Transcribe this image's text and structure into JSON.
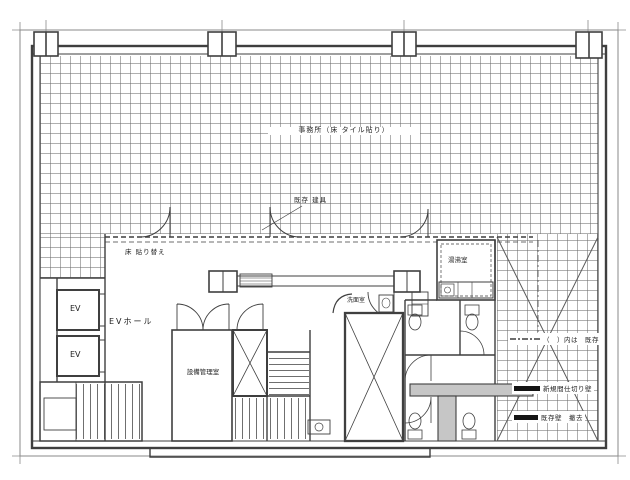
{
  "drawing": {
    "type": "architectural-floor-plan",
    "labels": {
      "office": "事務所（床 タイル貼り）",
      "fixture_note": "既存 建具",
      "floor_note": "床 貼り替え",
      "ev_hall": "EVホール",
      "ev_1": "EV",
      "ev_2": "EV",
      "equipment_room": "設備管理室",
      "water_room": "湯沸室",
      "washroom": "洗面室"
    },
    "legend": {
      "items": [
        {
          "swatch": "dash-dot-line",
          "label": "（　）内は　既存"
        },
        {
          "swatch": "solid-black-bar",
          "label": "新規間仕切り壁"
        },
        {
          "swatch": "solid-black-bar",
          "label": "既存壁　撤去"
        }
      ]
    },
    "colors": {
      "paper": "#ffffff",
      "line": "#3f3f3f",
      "grid_line": "#6e6e6e",
      "wall_poche": "#c6c6c6",
      "legend_fill": "#141414"
    }
  }
}
